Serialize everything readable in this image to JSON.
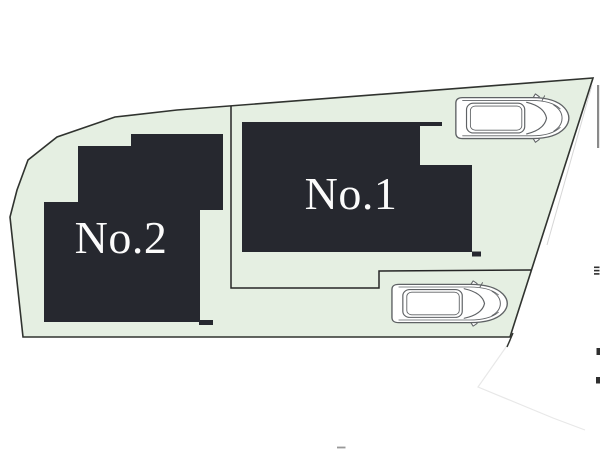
{
  "plan": {
    "title": "two-lot site plan with parking",
    "lots": [
      {
        "id": "no1",
        "label": "No.1"
      },
      {
        "id": "no2",
        "label": "No.2"
      }
    ],
    "cars_count": 2,
    "colors": {
      "land_fill": "#e5efe2",
      "land_outline": "#30332f",
      "building_fill": "#26282f",
      "label_text": "#fbfbfb",
      "divider_line": "#262626",
      "car_outline": "#5f6265",
      "faint_line": "#e8e8e8",
      "edge_mark": "#2f2f2f",
      "edge_gray": "#8a8a8a"
    }
  }
}
